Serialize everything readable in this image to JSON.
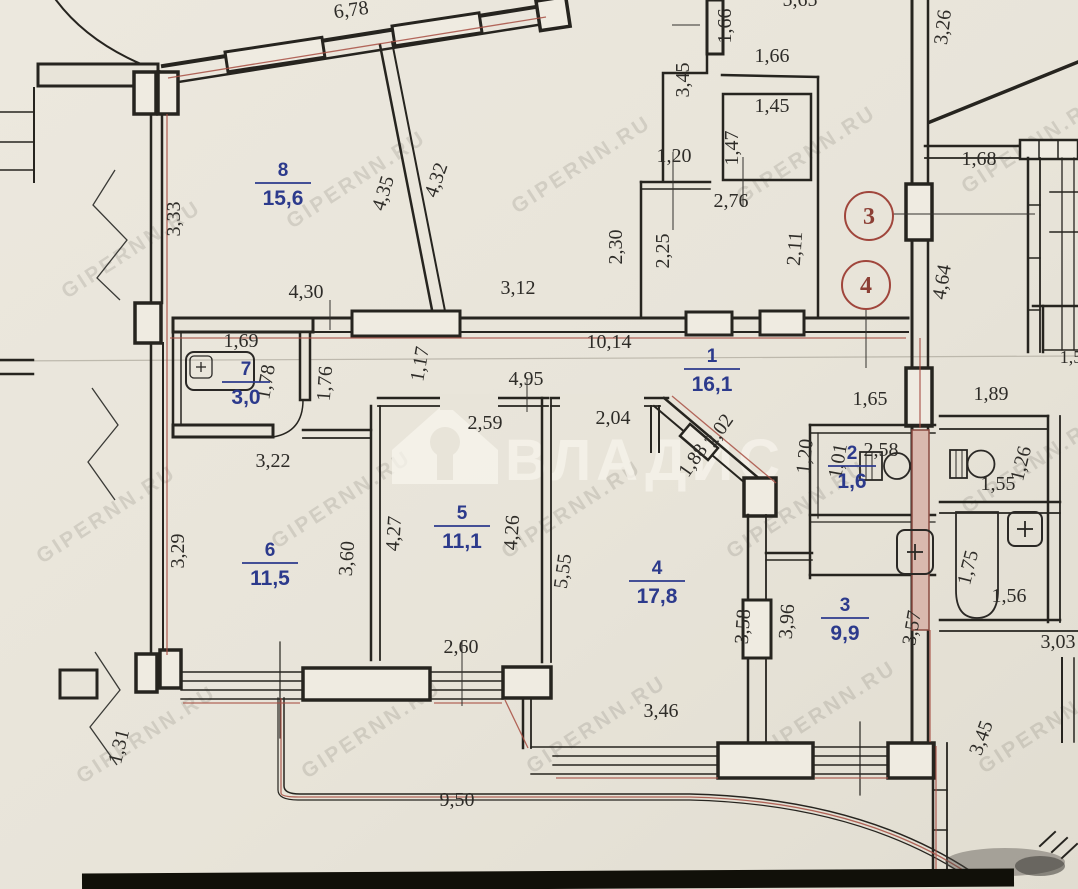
{
  "plan": {
    "colors": {
      "paper": "#e8e4d9",
      "wall": "#26241f",
      "room_label_blue": "#2c3a8c",
      "boundary_red": "#a84f43",
      "callout_red": "#a0463c",
      "watermark_gray": "#5f5b52",
      "brand_white": "#f7f4ec"
    },
    "watermark": {
      "brand": "ВЛАДИС",
      "tile": "GIPERNN.RU",
      "tile_positions": [
        [
          135,
          255
        ],
        [
          360,
          185
        ],
        [
          585,
          170
        ],
        [
          810,
          160
        ],
        [
          1035,
          150
        ],
        [
          110,
          520
        ],
        [
          345,
          505
        ],
        [
          575,
          515
        ],
        [
          800,
          515
        ],
        [
          1035,
          470
        ],
        [
          150,
          740
        ],
        [
          375,
          735
        ],
        [
          600,
          730
        ],
        [
          830,
          715
        ],
        [
          1052,
          730
        ]
      ]
    },
    "rooms": [
      {
        "number": "8",
        "area": "15,6",
        "x": 283,
        "y": 176
      },
      {
        "number": "7",
        "area": "3,0",
        "x": 246,
        "y": 375
      },
      {
        "number": "1",
        "area": "16,1",
        "x": 712,
        "y": 362
      },
      {
        "number": "2",
        "area": "1,6",
        "x": 852,
        "y": 459
      },
      {
        "number": "6",
        "area": "11,5",
        "x": 270,
        "y": 556
      },
      {
        "number": "5",
        "area": "11,1",
        "x": 462,
        "y": 519
      },
      {
        "number": "4",
        "area": "17,8",
        "x": 657,
        "y": 574
      },
      {
        "number": "3",
        "area": "9,9",
        "x": 845,
        "y": 611
      }
    ],
    "dimensions": [
      {
        "t": "6,78",
        "x": 352,
        "y": 16,
        "r": -8
      },
      {
        "t": "5,65",
        "x": 800,
        "y": 6,
        "r": 0
      },
      {
        "t": "1,66",
        "x": 731,
        "y": 26,
        "r": -90
      },
      {
        "t": "1,66",
        "x": 772,
        "y": 62,
        "r": 0
      },
      {
        "t": "3,45",
        "x": 689,
        "y": 80,
        "r": -90
      },
      {
        "t": "3,26",
        "x": 949,
        "y": 28,
        "r": -83
      },
      {
        "t": "1,45",
        "x": 772,
        "y": 112,
        "r": 0
      },
      {
        "t": "1,47",
        "x": 738,
        "y": 148,
        "r": -90
      },
      {
        "t": "1,20",
        "x": 674,
        "y": 162,
        "r": 0
      },
      {
        "t": "2,76",
        "x": 731,
        "y": 207,
        "r": 0
      },
      {
        "t": "2,30",
        "x": 622,
        "y": 247,
        "r": -90
      },
      {
        "t": "2,25",
        "x": 669,
        "y": 251,
        "r": -90
      },
      {
        "t": "2,11",
        "x": 801,
        "y": 249,
        "r": -86
      },
      {
        "t": "1,68",
        "x": 979,
        "y": 165,
        "r": 0
      },
      {
        "t": "4,64",
        "x": 948,
        "y": 283,
        "r": -80
      },
      {
        "t": "3,33",
        "x": 180,
        "y": 219,
        "r": -90
      },
      {
        "t": "4,35",
        "x": 389,
        "y": 195,
        "r": -73
      },
      {
        "t": "4,32",
        "x": 442,
        "y": 182,
        "r": -71
      },
      {
        "t": "4,30",
        "x": 306,
        "y": 298,
        "r": 0
      },
      {
        "t": "3,12",
        "x": 518,
        "y": 294,
        "r": 0
      },
      {
        "t": "10,14",
        "x": 609,
        "y": 348,
        "r": 0
      },
      {
        "t": "1,69",
        "x": 241,
        "y": 347,
        "r": 0
      },
      {
        "t": "1,78",
        "x": 272,
        "y": 383,
        "r": -80
      },
      {
        "t": "1,76",
        "x": 331,
        "y": 384,
        "r": -86
      },
      {
        "t": "1,17",
        "x": 426,
        "y": 365,
        "r": -80
      },
      {
        "t": "4,95",
        "x": 526,
        "y": 385,
        "r": 0
      },
      {
        "t": "2,59",
        "x": 485,
        "y": 429,
        "r": 0
      },
      {
        "t": "2,04",
        "x": 613,
        "y": 424,
        "r": 0
      },
      {
        "t": "2,02",
        "x": 724,
        "y": 434,
        "r": -55
      },
      {
        "t": "1,88",
        "x": 698,
        "y": 464,
        "r": -55
      },
      {
        "t": "1,65",
        "x": 870,
        "y": 405,
        "r": 0
      },
      {
        "t": "1,89",
        "x": 991,
        "y": 400,
        "r": 0
      },
      {
        "t": "1,20",
        "x": 811,
        "y": 457,
        "r": -84
      },
      {
        "t": "1,01",
        "x": 844,
        "y": 462,
        "r": -80
      },
      {
        "t": "2,58",
        "x": 881,
        "y": 456,
        "r": 0
      },
      {
        "t": "1,55",
        "x": 998,
        "y": 490,
        "r": 0
      },
      {
        "t": "1,26",
        "x": 1027,
        "y": 465,
        "r": -76
      },
      {
        "t": "3,22",
        "x": 273,
        "y": 467,
        "r": 0
      },
      {
        "t": "3,29",
        "x": 184,
        "y": 551,
        "r": -90
      },
      {
        "t": "3,60",
        "x": 353,
        "y": 559,
        "r": -86
      },
      {
        "t": "4,27",
        "x": 400,
        "y": 534,
        "r": -86
      },
      {
        "t": "4,26",
        "x": 518,
        "y": 533,
        "r": -86
      },
      {
        "t": "5,55",
        "x": 569,
        "y": 572,
        "r": -82
      },
      {
        "t": "2,60",
        "x": 461,
        "y": 653,
        "r": 0
      },
      {
        "t": "3,58",
        "x": 749,
        "y": 627,
        "r": -86
      },
      {
        "t": "3,96",
        "x": 793,
        "y": 622,
        "r": -86
      },
      {
        "t": "3,57",
        "x": 918,
        "y": 629,
        "r": -80
      },
      {
        "t": "3,46",
        "x": 661,
        "y": 717,
        "r": 0
      },
      {
        "t": "1,75",
        "x": 974,
        "y": 569,
        "r": -76
      },
      {
        "t": "1,56",
        "x": 1009,
        "y": 602,
        "r": 0
      },
      {
        "t": "3,03",
        "x": 1058,
        "y": 648,
        "r": 0
      },
      {
        "t": "1,31",
        "x": 125,
        "y": 748,
        "r": -76
      },
      {
        "t": "9,50",
        "x": 457,
        "y": 806,
        "r": 0
      },
      {
        "t": "3,45",
        "x": 987,
        "y": 740,
        "r": -70
      },
      {
        "t": "1,5",
        "x": 1071,
        "y": 363,
        "r": 0
      }
    ],
    "callouts": [
      {
        "label": "3",
        "x": 869,
        "y": 216
      },
      {
        "label": "4",
        "x": 866,
        "y": 285
      }
    ]
  }
}
